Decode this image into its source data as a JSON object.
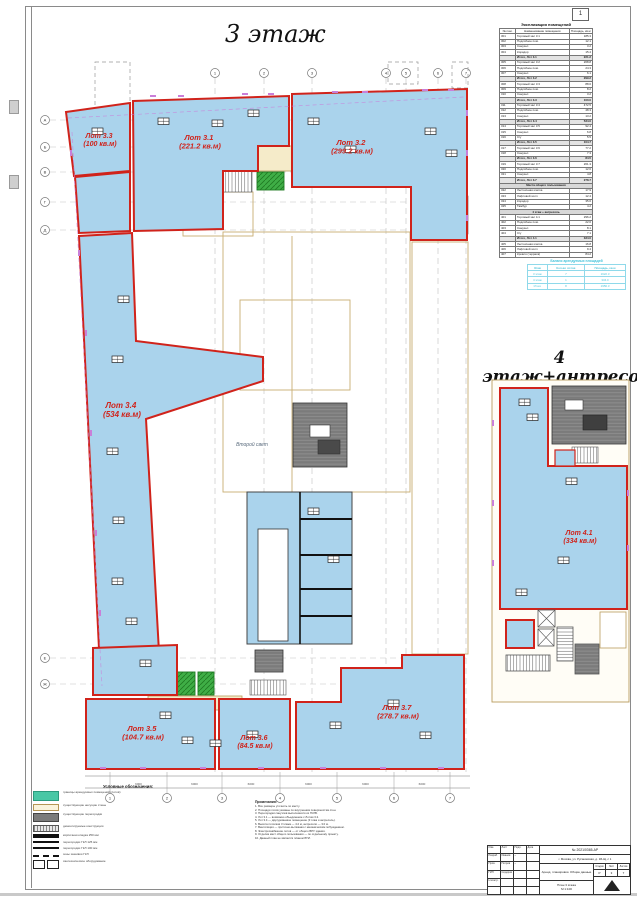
{
  "page": {
    "sheet_corner_number": "1"
  },
  "plan3": {
    "title": "3 этаж",
    "void_label": "Второй свет",
    "lots": [
      {
        "label": "Лот 3.3",
        "area": "(100 кв.м)"
      },
      {
        "label": "Лот 3.1",
        "area": "(221.2 кв.м)"
      },
      {
        "label": "Лот 3.2",
        "area": "(299.2 кв.м)"
      },
      {
        "label": "Лот 3.4",
        "area": "(534 кв.м)"
      },
      {
        "label": "Лот 3.5",
        "area": "(104.7 кв.м)"
      },
      {
        "label": "Лот 3.6",
        "area": "(84.5 кв.м)"
      },
      {
        "label": "Лот 3.7",
        "area": "(278.7 кв.м)"
      }
    ]
  },
  "plan4": {
    "title": "4 этаж+антресоль",
    "lot": {
      "label": "Лот 4.1",
      "area": "(334 кв.м)"
    }
  },
  "colors": {
    "lot_fill": "#aad3ec",
    "lot_border": "#d0231b",
    "corridor": "#f5ebc9",
    "elevator_green": "#3fae46",
    "tech_gray": "#7b7b7b",
    "legend_teal": "#49c7a5",
    "window_tick": "#c97fd9",
    "mini_table_cyan": "#52c5da"
  },
  "explication": {
    "title": "Экспликация помещений",
    "columns": [
      "№ пом.",
      "Наименование помещения",
      "Площадь, кв.м"
    ],
    "rows": [
      {
        "n": "301",
        "name": "Торговый зал 3.1",
        "a": "185.3"
      },
      {
        "n": "302",
        "name": "Подсобное пом.",
        "a": "12.1"
      },
      {
        "n": "303",
        "name": "Санузел",
        "a": "3.2"
      },
      {
        "n": "304",
        "name": "Коридор",
        "a": "15.4"
      },
      {
        "n": "",
        "name": "Итого, Лот 3.1",
        "a": "221.2",
        "sum": true
      },
      {
        "n": "305",
        "name": "Торговый зал 3.2",
        "a": "268.8"
      },
      {
        "n": "306",
        "name": "Подсобное пом.",
        "a": "24.3"
      },
      {
        "n": "307",
        "name": "Санузел",
        "a": "6.1"
      },
      {
        "n": "",
        "name": "Итого, Лот 3.2",
        "a": "299.2",
        "sum": true
      },
      {
        "n": "308",
        "name": "Торговый зал 3.3",
        "a": "88.6"
      },
      {
        "n": "309",
        "name": "Подсобное пом.",
        "a": "8.2"
      },
      {
        "n": "310",
        "name": "Санузел",
        "a": "3.2"
      },
      {
        "n": "",
        "name": "Итого, Лот 3.3",
        "a": "100.0",
        "sum": true
      },
      {
        "n": "311",
        "name": "Торговый зал 3.4",
        "a": "472.5"
      },
      {
        "n": "312",
        "name": "Подсобное пом.",
        "a": "48.3"
      },
      {
        "n": "313",
        "name": "Санузел",
        "a": "13.2"
      },
      {
        "n": "",
        "name": "Итого, Лот 3.4",
        "a": "534.0",
        "sum": true
      },
      {
        "n": "314",
        "name": "Торговый зал 3.5",
        "a": "92.4"
      },
      {
        "n": "315",
        "name": "Санузел",
        "a": "6.8"
      },
      {
        "n": "316",
        "name": "С/у",
        "a": "5.5"
      },
      {
        "n": "",
        "name": "Итого, Лот 3.5",
        "a": "104.7",
        "sum": true
      },
      {
        "n": "317",
        "name": "Торговый зал 3.6",
        "a": "77.2"
      },
      {
        "n": "318",
        "name": "Санузел",
        "a": "7.3"
      },
      {
        "n": "",
        "name": "Итого, Лот 3.6",
        "a": "84.5",
        "sum": true
      },
      {
        "n": "319",
        "name": "Торговый зал 3.7",
        "a": "261.3"
      },
      {
        "n": "320",
        "name": "Подсобное пом.",
        "a": "12.6"
      },
      {
        "n": "321",
        "name": "Санузел",
        "a": "4.8"
      },
      {
        "n": "",
        "name": "Итого, Лот 3.7",
        "a": "278.7",
        "sum": true
      },
      {
        "sec": "Места общего пользования"
      },
      {
        "n": "322",
        "name": "Лестничная клетка",
        "a": "17.9"
      },
      {
        "n": "323",
        "name": "Лифтовой холл",
        "a": "12.4"
      },
      {
        "n": "324",
        "name": "Коридор",
        "a": "35.6"
      },
      {
        "n": "325",
        "name": "Тамбур",
        "a": "4.2"
      },
      {
        "sec": "4 этаж + антресоль"
      },
      {
        "n": "401",
        "name": "Торговый зал 4.1",
        "a": "296.2"
      },
      {
        "n": "402",
        "name": "Подсобное пом.",
        "a": "22.6"
      },
      {
        "n": "403",
        "name": "Санузел",
        "a": "8.1"
      },
      {
        "n": "404",
        "name": "С/у",
        "a": "7.1"
      },
      {
        "n": "",
        "name": "Итого, Лот 4.1",
        "a": "334.0",
        "sum": true
      },
      {
        "n": "405",
        "name": "Лестничная клетка",
        "a": "16.8"
      },
      {
        "n": "406",
        "name": "Лифтовой холл",
        "a": "9.4"
      },
      {
        "n": "407",
        "name": "Кровля (терраса)",
        "a": "84.2"
      }
    ]
  },
  "mini_table": {
    "title": "Баланс арендуемых площадей",
    "columns": [
      "Этаж",
      "Кол-во лотов",
      "Площадь, кв.м"
    ],
    "rows": [
      [
        "3 этаж",
        "7",
        "1622.3"
      ],
      [
        "4 этаж",
        "1",
        "334.0"
      ],
      [
        "Итого",
        "8",
        "1956.3"
      ]
    ]
  },
  "legend": {
    "title": "Условные обозначения:",
    "items": [
      {
        "type": "teal",
        "text": "границы арендуемых помещений (лотов)"
      },
      {
        "type": "wall",
        "text": "существующие несущие стены"
      },
      {
        "type": "gray",
        "text": "существующие перегородки"
      },
      {
        "type": "hatch",
        "text": "демонтируемые конструкции"
      },
      {
        "type": "bar1",
        "text": "кирпичная кладка 250 мм"
      },
      {
        "type": "bar2",
        "text": "перегородки ГКЛ 125 мм"
      },
      {
        "type": "bar3",
        "text": "перегородки ГКЛ 100 мм"
      },
      {
        "type": "dash",
        "text": "зоны зашивки ГКЛ"
      },
      {
        "type": "wc",
        "text": "сантехническое оборудование"
      }
    ]
  },
  "notes": {
    "title": "Примечания:",
    "lines": [
      "1. Все размеры уточнять по месту.",
      "2. Площади лотов указаны по внутренним поверхностям стен.",
      "3. Перегородки санузлов выполняются из ГКЛВ.",
      "4. Лот 3.1 — возможно объединение с Лотом 3.2.",
      "5. Лот 3.4 — двухуровневое помещение (3 этаж и антресоль).",
      "6. Высота потолков 3 этажа — 4.2 м, антресоли — 3.0 м.",
      "7. Вентиляция — приточно-вытяжная с механическим побуждением.",
      "8. Электроснабжение лотов — от общего ВРУ здания.",
      "9. Отделка мест общего пользования — по отдельному проекту.",
      "10. Данный план не является планом БТИ."
    ]
  },
  "title_block": {
    "doc_number": "№ 2021/0365-АР",
    "address": "г. Москва, ул. Русаковская, д. 1Б-Щ, с 1",
    "doc_title": "Аренд. планировки. Общие данные",
    "drawing_name": "План 3 этажа",
    "scale": "М 1:100",
    "stage_label": "Стадия",
    "sheet_label": "Лист",
    "sheets_label": "Листов",
    "stage": "Р",
    "sheet": "3",
    "sheets": "7",
    "grid_rows": [
      [
        "Изм.",
        "Лист",
        "Подп.",
        "Дата"
      ],
      [
        "Разраб.",
        "Иванов",
        "~",
        ""
      ],
      [
        "Пров.",
        "Петров",
        "~",
        ""
      ],
      [
        "ГИП",
        "Сидоров",
        "",
        ""
      ],
      [
        "Н.контр.",
        "",
        "",
        ""
      ],
      [
        "",
        "",
        "",
        ""
      ]
    ]
  },
  "axes": {
    "top": [
      {
        "l": "1",
        "x": 215
      },
      {
        "l": "2",
        "x": 264
      },
      {
        "l": "3",
        "x": 312
      },
      {
        "l": "4",
        "x": 386
      },
      {
        "l": "5",
        "x": 406
      },
      {
        "l": "6",
        "x": 438
      },
      {
        "l": "7",
        "x": 466
      }
    ],
    "left": [
      {
        "l": "А",
        "y": 120
      },
      {
        "l": "Б",
        "y": 147
      },
      {
        "l": "В",
        "y": 172
      },
      {
        "l": "Г",
        "y": 202
      },
      {
        "l": "Д",
        "y": 230
      },
      {
        "l": "Е",
        "y": 658
      },
      {
        "l": "Ж",
        "y": 684
      }
    ],
    "bottom": [
      {
        "l": "1",
        "x": 110
      },
      {
        "l": "2",
        "x": 167
      },
      {
        "l": "3",
        "x": 222
      },
      {
        "l": "4",
        "x": 280
      },
      {
        "l": "5",
        "x": 337
      },
      {
        "l": "6",
        "x": 394
      },
      {
        "l": "7",
        "x": 450
      }
    ],
    "dim": "6000"
  }
}
